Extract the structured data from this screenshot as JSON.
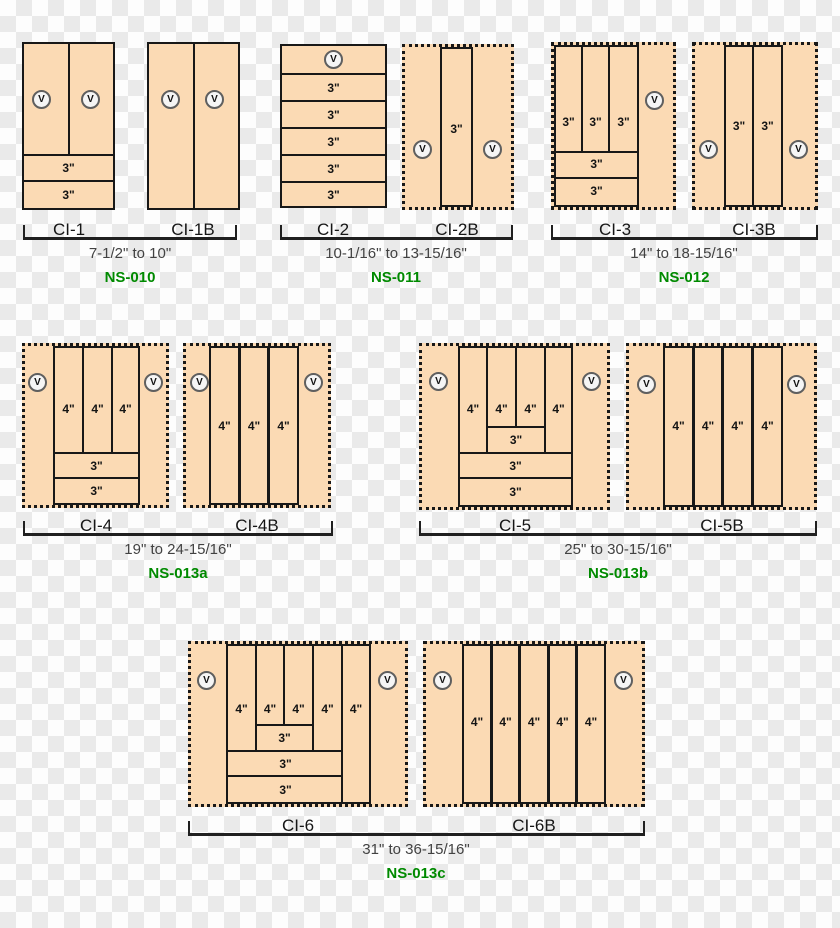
{
  "labels": {
    "v": "V",
    "d3": "3\"",
    "d4": "4\""
  },
  "groups": [
    {
      "variant_a": "CI-1",
      "variant_b": "CI-1B",
      "size_range": "7-1/2\" to 10\"",
      "code": "NS-010"
    },
    {
      "variant_a": "CI-2",
      "variant_b": "CI-2B",
      "size_range": "10-1/16\" to 13-15/16\"",
      "code": "NS-011"
    },
    {
      "variant_a": "CI-3",
      "variant_b": "CI-3B",
      "size_range": "14\" to 18-15/16\"",
      "code": "NS-012"
    },
    {
      "variant_a": "CI-4",
      "variant_b": "CI-4B",
      "size_range": "19\" to 24-15/16\"",
      "code": "NS-013a"
    },
    {
      "variant_a": "CI-5",
      "variant_b": "CI-5B",
      "size_range": "25\" to 30-15/16\"",
      "code": "NS-013b"
    },
    {
      "variant_a": "CI-6",
      "variant_b": "CI-6B",
      "size_range": "31\" to 36-15/16\"",
      "code": "NS-013c"
    }
  ],
  "colors": {
    "panel_fill": "#FBDAB4",
    "line_black": "#181818",
    "code_green": "#008A00",
    "size_text": "#424242",
    "checker_light": "#FDFDFD",
    "checker_gray": "#EAEAEA"
  }
}
